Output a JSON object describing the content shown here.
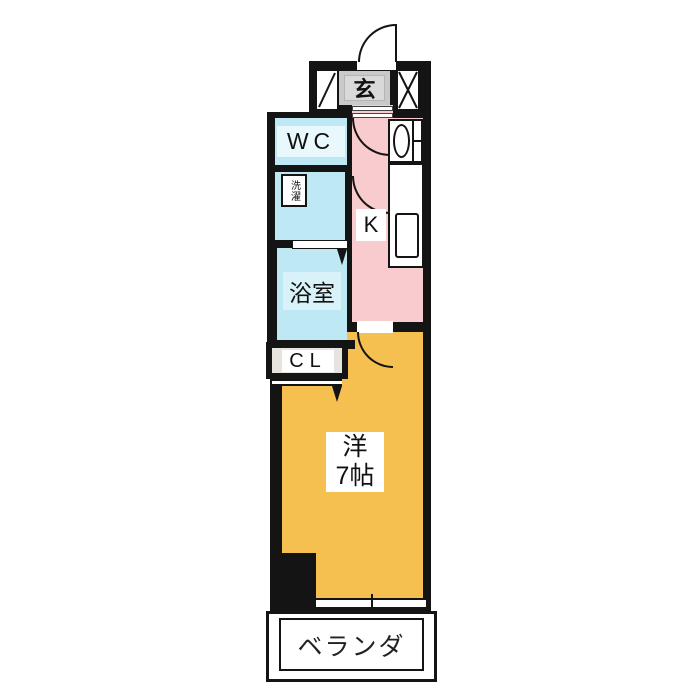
{
  "plan": {
    "type": "apartment-floor-plan",
    "rooms": {
      "genkan": {
        "label": "玄"
      },
      "wc": {
        "label": "WC"
      },
      "laundry": {
        "label": "洗濯"
      },
      "kitchen": {
        "label": "K"
      },
      "bathroom": {
        "label": "浴室"
      },
      "closet": {
        "label": "CL"
      },
      "western_room": {
        "label_line1": "洋",
        "label_line2": "7帖"
      },
      "veranda": {
        "label": "ベランダ"
      }
    },
    "colors": {
      "wall": "#141414",
      "water_rooms": "#BEE8F4",
      "kitchen_hall": "#F8CBCE",
      "main_room": "#F5C050",
      "genkan_gray": "#C9C9C9",
      "closet_beige": "#E7E4DF",
      "background": "#FFFFFF"
    }
  }
}
